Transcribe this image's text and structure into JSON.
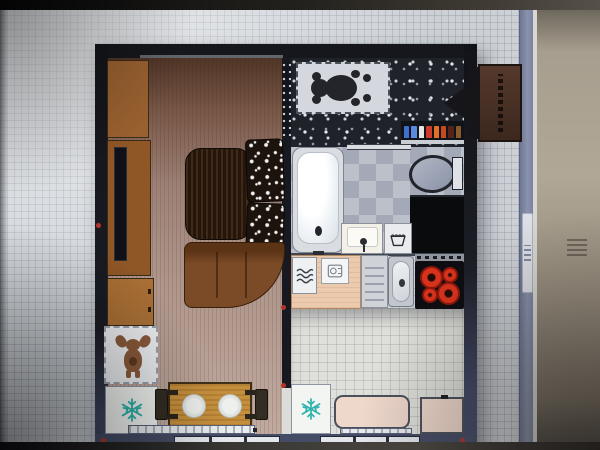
{
  "scene": {
    "kind": "photo-of-monitor",
    "content": "2D top-down floor plan of a studio apartment shown in an interior-design planner app",
    "visible_text": []
  },
  "canvas": {
    "background": "graph-paper-grid",
    "scrollbar": {
      "orientation": "vertical",
      "grip_lines": 4
    }
  },
  "colors": {
    "marker-red": "#b5342a",
    "wood-cabinet": "#9a6130",
    "sofa-brown": "#7b4a26",
    "table-wood": "#c48f3c",
    "deer-brown": "#8a5a3a",
    "bear-dark": "#23252b",
    "burner-red": "#d8321c",
    "pink-furniture": "#eed7cb",
    "teal-snowflake": "#2fb3ad"
  },
  "plan": {
    "wall_style": "dark charcoal outer walls, slate-blue bottom wall",
    "red_corner_markers": 5,
    "rooms": [
      {
        "name": "living-room",
        "floor": "brown wood plank",
        "items": [
          "wardrobe",
          "tv-cabinet",
          "tv",
          "dresser",
          "deer-rug",
          "refrigerator",
          "coffee-table",
          "patterned-armchair",
          "patterned-armchair",
          "corner-sofa",
          "dining-table",
          "dining-chair",
          "dining-chair",
          "radiator",
          "window"
        ]
      },
      {
        "name": "hallway",
        "floor": "dark pebble mosaic",
        "items": [
          "teddy-bear-rug",
          "cosmetics-shelf"
        ]
      },
      {
        "name": "bathroom",
        "floor": "gray checker tile",
        "items": [
          "bathtub",
          "toilet",
          "washing-machine",
          "washbasin",
          "laundry-basket"
        ]
      },
      {
        "name": "kitchen",
        "floor": "light square tile",
        "items": [
          "heated-towel-rail",
          "counter",
          "coffee-machine",
          "drainboard",
          "sink",
          "cooktop",
          "refrigerator",
          "bench",
          "side-table",
          "radiator",
          "window"
        ]
      }
    ],
    "cooktop": {
      "burners": 4,
      "layout": "2 large diagonal + 2 small diagonal"
    },
    "dining_plates": 2,
    "window_panes_per_window": 3,
    "shelf_bottles": [
      "#3f6fd0",
      "#5a8adf",
      "#e8e6e0",
      "#d03a2a",
      "#e2702a",
      "#c8491f",
      "#55231a",
      "#8a5a2e"
    ],
    "entrance_marker": {
      "type": "sign-with-arrow",
      "direction": "left"
    }
  }
}
